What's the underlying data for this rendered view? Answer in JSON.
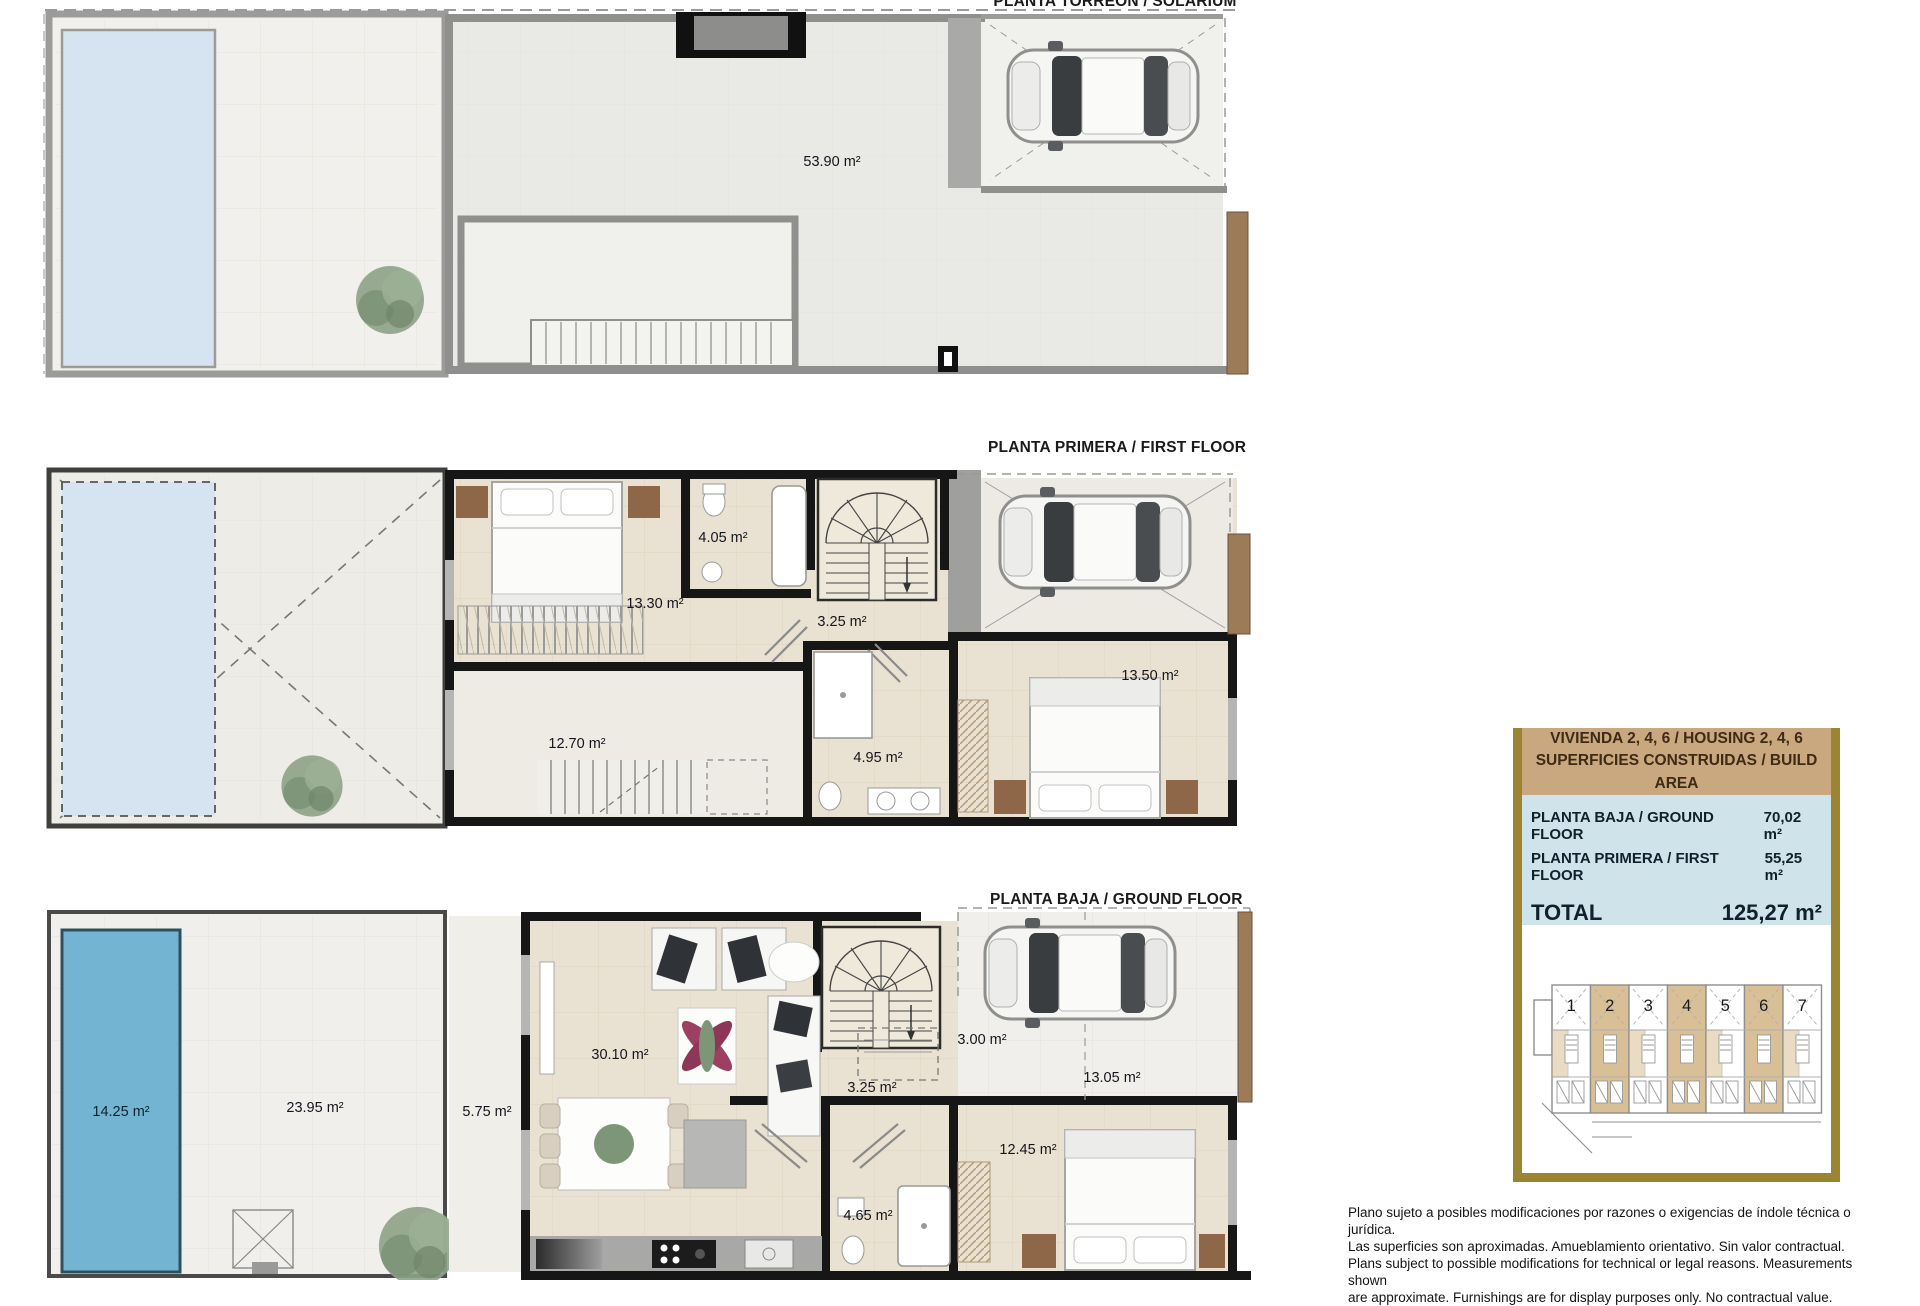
{
  "titles": {
    "solarium": "PLANTA TORREÓN / SOLARIUM",
    "first_floor": "PLANTA PRIMERA / FIRST FLOOR",
    "ground_floor": "PLANTA BAJA / GROUND FLOOR"
  },
  "plans": {
    "solarium": {
      "labels": {
        "solarium_area": "53.90 m²"
      }
    },
    "first_floor": {
      "labels": {
        "bathroom": "4.05 m²",
        "bedroom_1": "13.30 m²",
        "hall": "3.25 m²",
        "bedroom_2": "13.50 m²",
        "terrace": "12.70 m²",
        "bathroom_2": "4.95 m²"
      }
    },
    "ground_floor": {
      "labels": {
        "pool": "14.25 m²",
        "patio": "23.95 m²",
        "porch": "5.75 m²",
        "living_kitchen": "30.10 m²",
        "hall": "3.25 m²",
        "storage": "3.00 m²",
        "parking": "13.05 m²",
        "bathroom": "4.65 m²",
        "bedroom": "12.45 m²"
      }
    }
  },
  "panel": {
    "title_line_1": "VIVIENDA 2, 4, 6 / HOUSING 2, 4, 6",
    "title_line_2": "SUPERFICIES CONSTRUIDAS / BUILD AREA",
    "rows": [
      {
        "label": "PLANTA BAJA / GROUND FLOOR",
        "value": "70,02 m²"
      },
      {
        "label": "PLANTA PRIMERA / FIRST FLOOR",
        "value": "55,25 m²"
      }
    ],
    "total": {
      "label": "TOTAL",
      "value": "125,27 m²"
    }
  },
  "site_plan": {
    "units": [
      {
        "number": "1"
      },
      {
        "number": "2"
      },
      {
        "number": "3"
      },
      {
        "number": "4"
      },
      {
        "number": "5"
      },
      {
        "number": "6"
      },
      {
        "number": "7"
      }
    ],
    "highlighted_units": "2, 4, 6"
  },
  "disclaimer": {
    "lines": [
      "Plano sujeto a posibles modificaciones por razones o exigencias de índole técnica o jurídica.",
      "Las superficies son aproximadas. Amueblamiento orientativo. Sin valor contractual.",
      "Plans subject to possible modifications for technical or legal reasons. Measurements shown",
      "are approximate. Furnishings are for display purposes only. No contractual value."
    ]
  },
  "colors": {
    "panel_border_gold": "#9b8533",
    "panel_header_tan": "#c9a87f",
    "panel_header_text": "#3f2a16",
    "panel_body_blue": "#cfe3ea",
    "panel_text_navy": "#10202c",
    "pool_blue": "#74b4d3",
    "pool_pale_blue": "#d5e4f0",
    "floor_beige": "#e9e1d1",
    "floor_light": "#f0efeb",
    "wall_black": "#161616",
    "wall_gray": "#8f8f8d",
    "site_unit_tan": "#d9bf96",
    "wood_brown": "#9b7b58"
  }
}
